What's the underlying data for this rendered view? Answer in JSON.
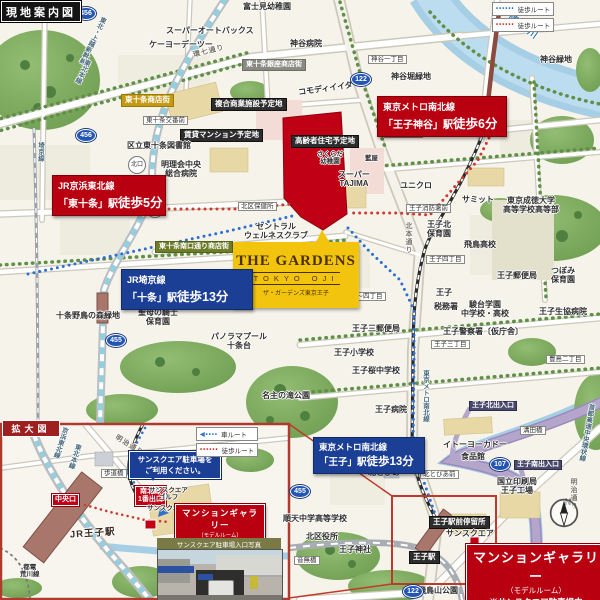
{
  "badges": {
    "main_map": "現地案内図",
    "inset_map": "拡大図"
  },
  "legend_main": {
    "rows": [
      {
        "label": "徒歩ルート",
        "color": "#2e6fd0"
      },
      {
        "label": "徒歩ルート",
        "color": "#d03a2e"
      }
    ]
  },
  "legend_inset": {
    "rows": [
      {
        "label": "車ルート",
        "color": "#2e6fd0"
      },
      {
        "label": "徒歩ルート",
        "color": "#d03a2e"
      }
    ]
  },
  "property_logo": {
    "name": "THE GARDENS",
    "sub": "TOKYO OJI",
    "reading": "ザ・ガーデンズ東京王子"
  },
  "station_boxes": [
    {
      "line": "JR京浜東北線",
      "station": "「東十条」駅",
      "walk": "徒歩5分"
    },
    {
      "line": "東京メトロ南北線",
      "station": "「王子神谷」駅",
      "walk": "徒歩6分"
    },
    {
      "line": "JR埼京線",
      "station": "「十条」駅",
      "walk": "徒歩13分"
    },
    {
      "line": "東京メトロ南北線",
      "station": "「王子」駅",
      "walk": "徒歩13分"
    }
  ],
  "gallery_main": {
    "title": "マンションギャラリー",
    "sub": "（モデルルーム）",
    "note": "※サンスクエア駐車場内"
  },
  "gallery_inset": {
    "title": "マンションギャラリー",
    "sub": "（モデルルーム）",
    "note": "※サンスクエア駐車場内"
  },
  "inset_callout": {
    "line1": "サンスクエア駐車場を",
    "line2": "ご利用ください。"
  },
  "photo_caption": "サンスクエア駐車場入口写真",
  "compass": {
    "north": "N"
  },
  "shields": [
    {
      "num": "456",
      "x": 76,
      "y": 7
    },
    {
      "num": "456",
      "x": 76,
      "y": 129
    },
    {
      "num": "122",
      "x": 351,
      "y": 73
    },
    {
      "num": "455",
      "x": 106,
      "y": 334
    },
    {
      "num": "455",
      "x": 290,
      "y": 485
    },
    {
      "num": "122",
      "x": 403,
      "y": 585
    },
    {
      "num": "107",
      "x": 490,
      "y": 458
    }
  ],
  "labels": [
    {
      "t": "スーパーオートバックス",
      "x": 166,
      "y": 26
    },
    {
      "t": "ケーヨーデーツー",
      "x": 149,
      "y": 40
    },
    {
      "t": "富士見幼稚園",
      "x": 243,
      "y": 2
    },
    {
      "t": "神谷病院",
      "x": 290,
      "y": 39
    },
    {
      "t": "神谷緑地",
      "x": 540,
      "y": 55
    },
    {
      "t": "東十条銀座商店街",
      "x": 242,
      "y": 59,
      "c": "gray-tag"
    },
    {
      "t": "コモディイイダ",
      "x": 298,
      "y": 84,
      "r": -8
    },
    {
      "t": "複合商業施設予定地",
      "x": 211,
      "y": 98,
      "c": "dark-tag"
    },
    {
      "t": "賃貸マンション予定地",
      "x": 180,
      "y": 129,
      "c": "dark-tag"
    },
    {
      "t": "高齢者住宅予定地",
      "x": 291,
      "y": 135,
      "c": "dark-tag"
    },
    {
      "t": "東十条商店街",
      "x": 121,
      "y": 94,
      "c": "gold-tag"
    },
    {
      "t": "東十条交番前",
      "x": 143,
      "y": 116,
      "c": "white-tag"
    },
    {
      "t": "区立東十条図書館",
      "x": 127,
      "y": 141
    },
    {
      "t": "明理会中央\n総合病院",
      "x": 161,
      "y": 160,
      "c": "c"
    },
    {
      "t": "北区保健所",
      "x": 238,
      "y": 202,
      "c": "white-tag"
    },
    {
      "t": "セントラル\nウェルネスクラブ",
      "x": 244,
      "y": 222,
      "c": "c"
    },
    {
      "t": "東十条南口通り商店街",
      "x": 155,
      "y": 241,
      "c": "green-tag"
    },
    {
      "t": "北口",
      "x": 128,
      "y": 156,
      "c": "circle-tag"
    },
    {
      "t": "南口",
      "x": 146,
      "y": 200,
      "c": "circle-tag"
    },
    {
      "t": "神谷一丁目",
      "x": 368,
      "y": 55,
      "c": "white-tag"
    },
    {
      "t": "神谷堀緑地",
      "x": 391,
      "y": 72
    },
    {
      "t": "王子五丁目",
      "x": 384,
      "y": 129,
      "c": "white-tag"
    },
    {
      "t": "さくらだ\n幼稚園",
      "x": 317,
      "y": 151,
      "c": "c sm"
    },
    {
      "t": "藍屋",
      "x": 365,
      "y": 155,
      "c": "sm"
    },
    {
      "t": "スーパー\nTAJIMA",
      "x": 338,
      "y": 170,
      "c": "c"
    },
    {
      "t": "ユニクロ",
      "x": 400,
      "y": 181
    },
    {
      "t": "王子消防署前",
      "x": 406,
      "y": 204,
      "c": "white-tag"
    },
    {
      "t": "サミット",
      "x": 462,
      "y": 195
    },
    {
      "t": "東京成徳大学\n高等学校高等部",
      "x": 503,
      "y": 196,
      "c": "c"
    },
    {
      "t": "王子北\n保育園",
      "x": 427,
      "y": 220,
      "c": "c"
    },
    {
      "t": "飛鳥高校",
      "x": 464,
      "y": 240
    },
    {
      "t": "王子郵便局",
      "x": 497,
      "y": 271
    },
    {
      "t": "つぼみ\n保育園",
      "x": 551,
      "y": 266,
      "c": "c"
    },
    {
      "t": "王子四丁目",
      "x": 426,
      "y": 255,
      "c": "white-tag"
    },
    {
      "t": "東十条一丁目",
      "x": 236,
      "y": 296,
      "c": "white-tag"
    },
    {
      "t": "王子三〜四丁目",
      "x": 334,
      "y": 292,
      "c": "white-tag"
    },
    {
      "t": "十条野鳥の森緑地",
      "x": 56,
      "y": 311
    },
    {
      "t": "聖母の騎士\n保育園",
      "x": 138,
      "y": 308,
      "c": "c"
    },
    {
      "t": "パノラマプール\n十条台",
      "x": 211,
      "y": 332,
      "c": "c"
    },
    {
      "t": "名主の滝公園",
      "x": 262,
      "y": 391
    },
    {
      "t": "王子三郵便局",
      "x": 352,
      "y": 324
    },
    {
      "t": "税務署",
      "x": 434,
      "y": 302
    },
    {
      "t": "駿台学園\n中学校・高校",
      "x": 461,
      "y": 300,
      "c": "c"
    },
    {
      "t": "王子生協病院",
      "x": 539,
      "y": 307
    },
    {
      "t": "王子警察署〔仮庁舎〕",
      "x": 443,
      "y": 327
    },
    {
      "t": "王子三丁目",
      "x": 431,
      "y": 340,
      "c": "white-tag"
    },
    {
      "t": "豊島二丁目",
      "x": 546,
      "y": 355,
      "c": "white-tag"
    },
    {
      "t": "王子小学校",
      "x": 334,
      "y": 348
    },
    {
      "t": "王子桜中学校",
      "x": 352,
      "y": 366
    },
    {
      "t": "王子病院",
      "x": 375,
      "y": 405
    },
    {
      "t": "王子",
      "x": 436,
      "y": 288
    },
    {
      "t": "王子北出入口",
      "x": 469,
      "y": 401,
      "c": "purple-tag"
    },
    {
      "t": "溝田橋",
      "x": 520,
      "y": 426,
      "c": "white-tag"
    },
    {
      "t": "イトーヨーカドー",
      "x": 443,
      "y": 440
    },
    {
      "t": "食品館",
      "x": 461,
      "y": 452
    },
    {
      "t": "王子南出入口",
      "x": 514,
      "y": 460,
      "c": "purple-tag"
    },
    {
      "t": "国立印刷局\n王子工場",
      "x": 497,
      "y": 477,
      "c": "c"
    },
    {
      "t": "北とぴあ",
      "x": 368,
      "y": 468
    },
    {
      "t": "北とぴあ前",
      "x": 420,
      "y": 470,
      "c": "white-tag"
    },
    {
      "t": "順天中学高等学校",
      "x": 283,
      "y": 514
    },
    {
      "t": "北区役所",
      "x": 306,
      "y": 532
    },
    {
      "t": "王子神社",
      "x": 339,
      "y": 545
    },
    {
      "t": "音無橋",
      "x": 294,
      "y": 556,
      "c": "white-tag"
    },
    {
      "t": "王子駅前停留所",
      "x": 429,
      "y": 516,
      "c": "dark-tag"
    },
    {
      "t": "サンスクエア",
      "x": 446,
      "y": 529
    },
    {
      "t": "王子駅",
      "x": 409,
      "y": 551,
      "c": "dark-tag"
    },
    {
      "t": "栄町停留所",
      "x": 509,
      "y": 587,
      "c": "dark-tag"
    },
    {
      "t": "飛鳥山公園",
      "x": 418,
      "y": 586
    },
    {
      "t": "隅田川",
      "x": 505,
      "y": 22,
      "c": "water",
      "r": 35
    },
    {
      "t": "環七通り",
      "x": 193,
      "y": 48,
      "c": "road",
      "r": -14
    },
    {
      "t": "北本通り",
      "x": 404,
      "y": 222,
      "c": "road vert"
    },
    {
      "t": "東北・上越新幹線",
      "x": 88,
      "y": 14,
      "c": "rail vert",
      "r": 26
    },
    {
      "t": "東北本線",
      "x": 78,
      "y": 58,
      "c": "rail vert",
      "r": 26
    },
    {
      "t": "埼京線",
      "x": 36,
      "y": 142,
      "c": "rail vert"
    },
    {
      "t": "東京メトロ南北線",
      "x": 421,
      "y": 370,
      "c": "rail vert"
    },
    {
      "t": "首都高速中央環状線",
      "x": 582,
      "y": 403,
      "c": "rail vert",
      "r": 10
    },
    {
      "t": "明治通り",
      "x": 569,
      "y": 478,
      "c": "road vert"
    },
    {
      "t": "京浜東北線",
      "x": 56,
      "y": 426,
      "c": "rail vert sm",
      "r": 18
    },
    {
      "t": "東北本線",
      "x": 70,
      "y": 443,
      "c": "rail vert sm",
      "r": 18
    },
    {
      "t": "明治通り",
      "x": 113,
      "y": 442,
      "c": "road",
      "r": 32
    },
    {
      "t": "歩道橋",
      "x": 101,
      "y": 469,
      "c": "white-tag"
    },
    {
      "t": "中央口",
      "x": 52,
      "y": 494,
      "c": "red-tag"
    },
    {
      "t": "南北線\n1番出口",
      "x": 135,
      "y": 486,
      "c": "red-tag c"
    },
    {
      "t": "サンスクエア\nゴルフ",
      "x": 149,
      "y": 487,
      "c": "c sm"
    },
    {
      "t": "サンスクエア",
      "x": 147,
      "y": 505,
      "c": "sm"
    },
    {
      "t": "JR王子駅",
      "x": 70,
      "y": 529,
      "c": "station-big",
      "r": -4
    },
    {
      "t": "都電\n荒川線",
      "x": 20,
      "y": 564,
      "c": "c sm"
    }
  ]
}
